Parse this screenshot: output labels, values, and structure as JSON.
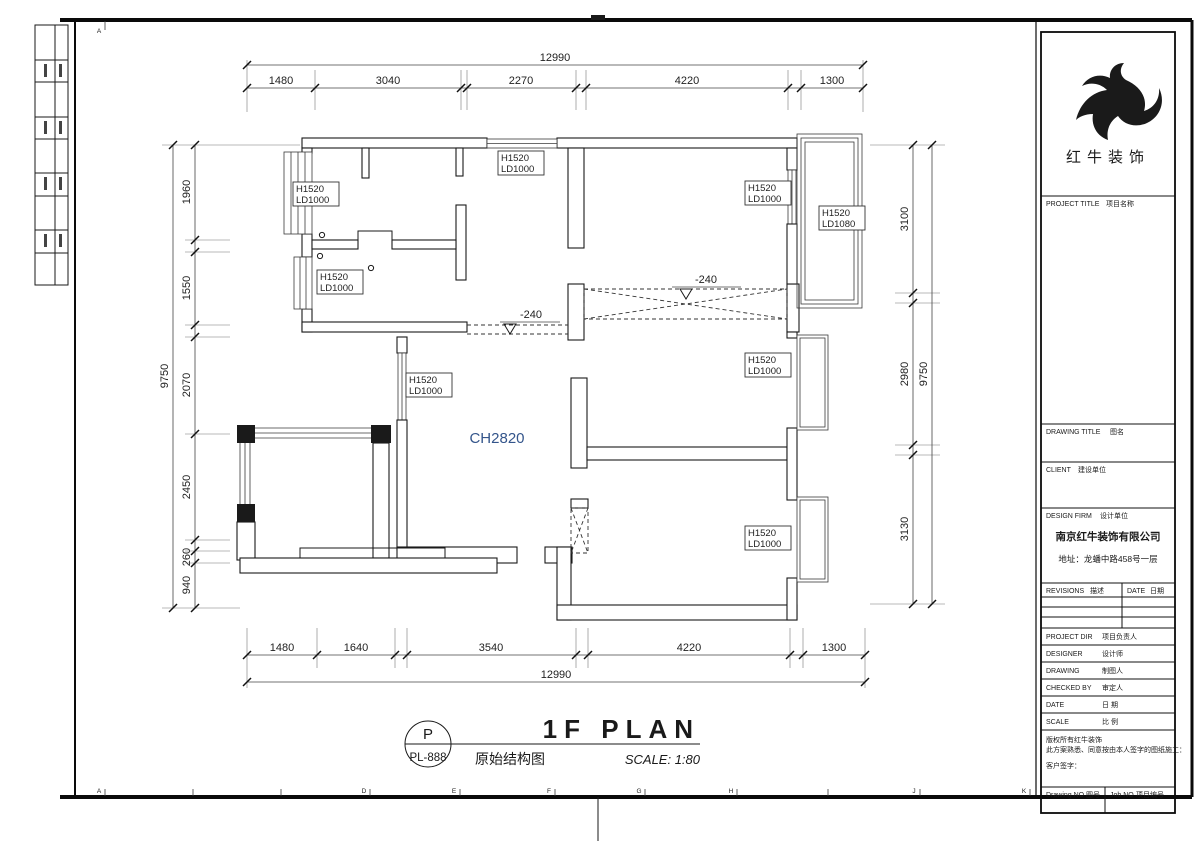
{
  "sheet": {
    "grid_letters_bottom": [
      "A",
      "D",
      "E",
      "F",
      "G",
      "H",
      "J",
      "K"
    ],
    "grid_letter_top": "A"
  },
  "dimensions": {
    "top": {
      "total": "12990",
      "segments": [
        "1480",
        "3040",
        "2270",
        "4220",
        "1300"
      ]
    },
    "bottom": {
      "total": "12990",
      "segments": [
        "1480",
        "1640",
        "3540",
        "4220",
        "1300"
      ]
    },
    "left": {
      "total": "9750",
      "segments": [
        "1960",
        "1550",
        "2070",
        "2450",
        "260",
        "940"
      ]
    },
    "right": {
      "total": "9750",
      "segments": [
        "3100",
        "2980",
        "3130"
      ]
    }
  },
  "plan": {
    "ceiling_height": "CH2820",
    "level_marker_1": "-240",
    "level_marker_2": "-240",
    "window_labels": [
      {
        "l1": "H1520",
        "l2": "LD1000"
      },
      {
        "l1": "H1520",
        "l2": "LD1000"
      },
      {
        "l1": "H1520",
        "l2": "LD1000"
      },
      {
        "l1": "H1520",
        "l2": "LD1000"
      },
      {
        "l1": "H1520",
        "l2": "LD1080"
      },
      {
        "l1": "H1520",
        "l2": "LD1000"
      },
      {
        "l1": "H1520",
        "l2": "LD1000"
      },
      {
        "l1": "H1520",
        "l2": "LD1000"
      }
    ]
  },
  "titlebar": {
    "code_letter": "P",
    "sheet_code": "PL-888",
    "title_en": "1F PLAN",
    "title_cn": "原始结构图",
    "scale_note": "SCALE: 1:80"
  },
  "titleblock": {
    "logo_text": "红牛装饰",
    "project_title_en": "PROJECT TITLE",
    "project_title_cn": "项目名称",
    "drawing_title_en": "DRAWING TITLE",
    "drawing_title_cn": "图名",
    "client_en": "CLIENT",
    "client_cn": "建设单位",
    "design_firm_en": "DESIGN FIRM",
    "design_firm_cn": "设计单位",
    "firm_name": "南京红牛装饰有限公司",
    "firm_address": "地址：龙蟠中路458号一层",
    "revisions_en": "REVISIONS",
    "revisions_cn": "描述",
    "rev_date_en": "DATE",
    "rev_date_cn": "日期",
    "project_dir_en": "PROJECT DIR",
    "project_dir_cn": "项目负责人",
    "designer_en": "DESIGNER",
    "designer_cn": "设计师",
    "drawing_en": "DRAWING",
    "drawing_cn": "制图人",
    "checked_by_en": "CHECKED BY",
    "checked_by_cn": "审定人",
    "date_en": "DATE",
    "date_cn": "日 期",
    "scale_en": "SCALE",
    "scale_cn": "比 例",
    "note_line1": "版权所有红牛装饰",
    "note_line2": "此方案熟悉、同意按由本人签字的图纸施工：",
    "note_line3": "客户签字：",
    "drawing_no_en": "Drawing NO",
    "drawing_no_cn": "图号",
    "job_no_en": "Job NO",
    "job_no_cn": "项目编号"
  }
}
